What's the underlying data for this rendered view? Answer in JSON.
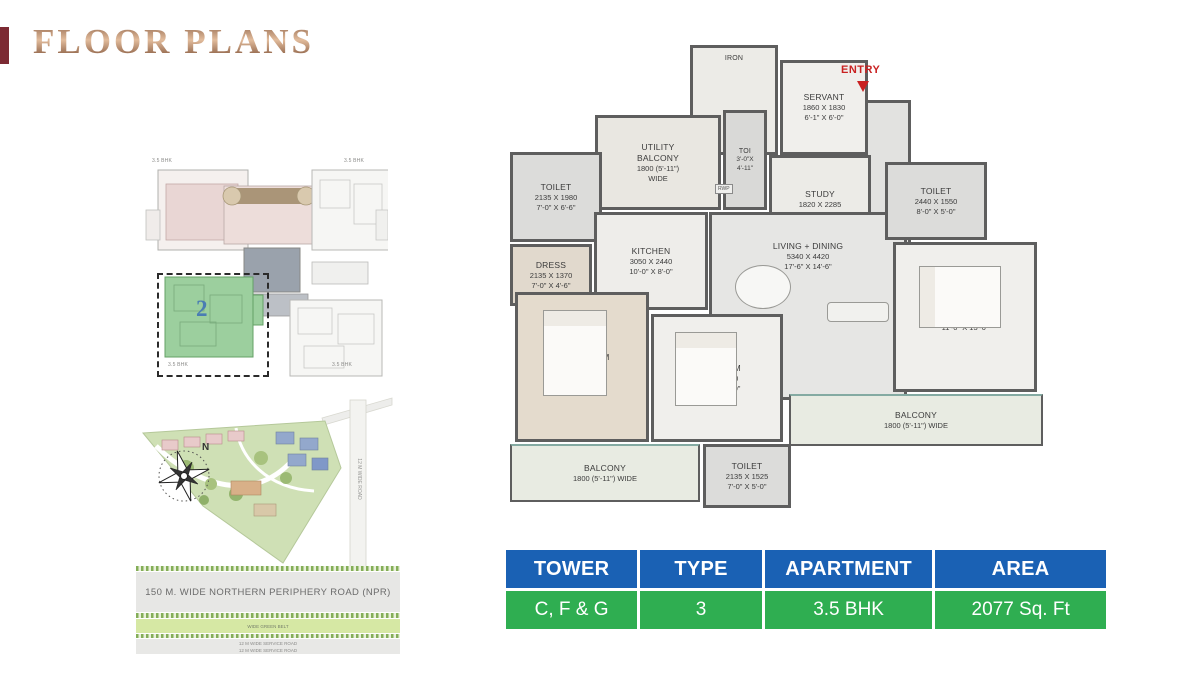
{
  "page_title": "FLOOR PLANS",
  "colors": {
    "accent_tab": "#7c2a33",
    "entry_red": "#c92121",
    "table_header": "#1a61b4",
    "table_row": "#2fae51",
    "keyplan_unit": "#4a7db3",
    "keyplan_green": "#9ccf9e"
  },
  "key_plan": {
    "unit_number": "2",
    "corner_labels": [
      "3.5 BHK",
      "3.5 BHK",
      "3.5 BHK",
      "3.5 BHK"
    ]
  },
  "site_plan": {
    "compass_north": "N",
    "npr_road": "150 M. WIDE NORTHERN PERIPHERY ROAD (NPR)",
    "green_belt": "WIDE GREEN BELT",
    "service_road_lines": [
      "12 M WIDE SERVICE ROAD",
      "12 M WIDE SERVICE ROAD"
    ],
    "side_road": "12 M WIDE ROAD"
  },
  "floor_plan": {
    "entry_label": "ENTRY",
    "rwp_label": "RWP",
    "rooms": [
      {
        "id": "iron",
        "name": "IRON",
        "mm": "",
        "ft": ""
      },
      {
        "id": "servant",
        "name": "SERVANT",
        "mm": "1860 X 1830",
        "ft": "6'-1\" X 6'-0\""
      },
      {
        "id": "toi",
        "name": "TOI",
        "mm": "3'-0\"X",
        "ft": "4'-11\""
      },
      {
        "id": "study",
        "name": "STUDY",
        "mm": "1820 X 2285",
        "ft": "6'-0\" X 7'-6\""
      },
      {
        "id": "utility-balcony",
        "name": "UTILITY BALCONY",
        "mm": "1800 (5'-11\")",
        "ft": "WIDE"
      },
      {
        "id": "toilet-tl",
        "name": "TOILET",
        "mm": "2135 X 1980",
        "ft": "7'-0\" X 6'-6\""
      },
      {
        "id": "dress",
        "name": "DRESS",
        "mm": "2135 X 1370",
        "ft": "7'-0\" X 4'-6\""
      },
      {
        "id": "kitchen",
        "name": "KITCHEN",
        "mm": "3050 X 2440",
        "ft": "10'-0\" X 8'-0\""
      },
      {
        "id": "living",
        "name": "LIVING + DINING",
        "mm": "5340 X 4420",
        "ft": "17'-6\" X 14'-6\""
      },
      {
        "id": "toilet-tr",
        "name": "TOILET",
        "mm": "2440 X 1550",
        "ft": "8'-0\" X 5'-0\""
      },
      {
        "id": "bedroom-right",
        "name": "BED ROOM",
        "mm": "3355 X 4110",
        "ft": "11'-0\" X 13'-6\""
      },
      {
        "id": "mbedroom",
        "name": "M.BEDROOM",
        "mm": "3350 X 4270",
        "ft": "11'-0\" X 14'-0\""
      },
      {
        "id": "bedroom-mid",
        "name": "BED ROOM",
        "mm": "3660 X 3350",
        "ft": "12'-0\" X 11'-0\""
      },
      {
        "id": "balcony-right",
        "name": "BALCONY",
        "mm": "1800 (5'-11\") WIDE",
        "ft": ""
      },
      {
        "id": "balcony-bottom",
        "name": "BALCONY",
        "mm": "1800 (5'-11\") WIDE",
        "ft": ""
      },
      {
        "id": "toilet-bottom",
        "name": "TOILET",
        "mm": "2135 X 1525",
        "ft": "7'-0\" X 5'-0\""
      }
    ]
  },
  "table": {
    "columns": [
      "TOWER",
      "TYPE",
      "APARTMENT",
      "AREA"
    ],
    "values": [
      "C, F & G",
      "3",
      "3.5 BHK",
      "2077 Sq. Ft"
    ]
  }
}
